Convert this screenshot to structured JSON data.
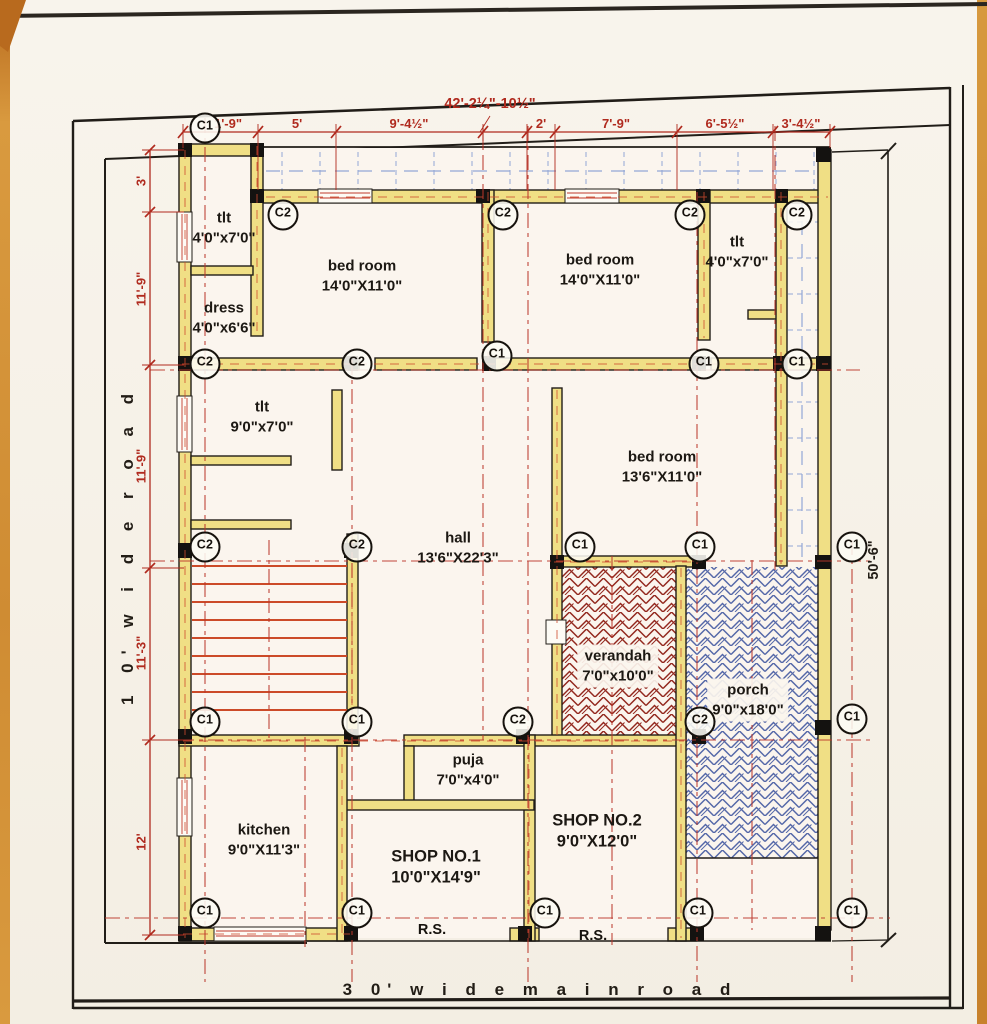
{
  "drawing": {
    "roads": {
      "left": "1 0'  w i d e  r o a d",
      "bottom": "3 0'  w i d e  m a i n  r o a d"
    },
    "overall": {
      "width_label": "42'-2¼\"-10½\"",
      "height_label": "50'-6\""
    },
    "top_chain": [
      "1'-9\"",
      "5'",
      "9'-4½\"",
      "2'",
      "7'-9\"",
      "6'-5½\"",
      "3'-4½\""
    ],
    "left_chain": [
      "3'",
      "11'-9\"",
      "11'-9\"",
      "11'-3\"",
      "12'"
    ],
    "rooms": {
      "tlt_a": {
        "name": "tlt",
        "size": "4'0\"x7'0\""
      },
      "dress": {
        "name": "dress",
        "size": "4'0\"x6'6\""
      },
      "bed_a": {
        "name": "bed room",
        "size": "14'0\"X11'0\""
      },
      "bed_b": {
        "name": "bed room",
        "size": "14'0\"X11'0\""
      },
      "tlt_b": {
        "name": "tlt",
        "size": "4'0\"x7'0\""
      },
      "tlt_c": {
        "name": "tlt",
        "size": "9'0\"x7'0\""
      },
      "bed_c": {
        "name": "bed room",
        "size": "13'6\"X11'0\""
      },
      "hall": {
        "name": "hall",
        "size": "13'6\"X22'3\""
      },
      "verandah": {
        "name": "verandah",
        "size": "7'0\"x10'0\""
      },
      "porch": {
        "name": "porch",
        "size": "9'0\"x18'0\""
      },
      "puja": {
        "name": "puja",
        "size": "7'0\"x4'0\""
      },
      "kitchen": {
        "name": "kitchen",
        "size": "9'0\"X11'3\""
      },
      "shop1": {
        "name": "SHOP NO.1",
        "size": "10'0\"X14'9\""
      },
      "shop2": {
        "name": "SHOP NO.2",
        "size": "9'0\"X12'0\""
      }
    },
    "labels": {
      "rs": "R.S."
    },
    "markers": {
      "c1": "C1",
      "c2": "C2"
    },
    "colors": {
      "paper": "#f7f2e9",
      "wall_fill": "#f0df85",
      "dim_red": "#b02a1e",
      "centerline_red": "#bb372b",
      "stair_tread": "#cc4a28",
      "verandah_hatch": "#93281e",
      "porch_hatch": "#5568a8",
      "chajja_blue": "#93a6d6",
      "ink_black": "#1d1a16",
      "scan_edge": "#d08a2e"
    }
  }
}
